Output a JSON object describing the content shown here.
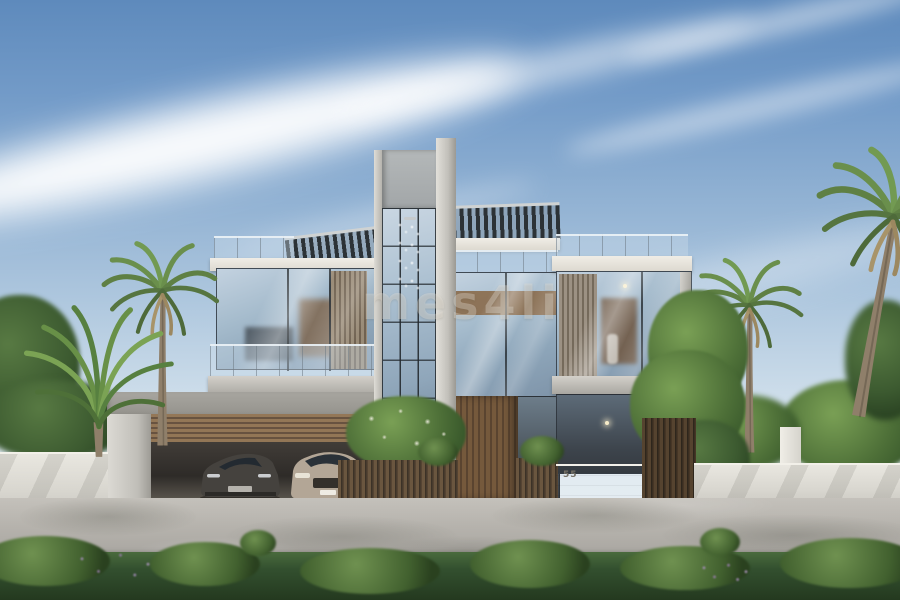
{
  "meta": {
    "type": "architectural-render",
    "description": "Front elevation render of a modern three-storey luxury villa with a central glass tower, glass-box wings, wood louvers, rooftop pergolas, a double carport with two cars, white boundary walls, a gated entrance marked 55, palm trees and garden greenery under a blue sky with wispy clouds"
  },
  "watermark": {
    "text": "mes4li"
  },
  "signage": {
    "house_number": "55"
  },
  "palette": {
    "sky_top": "#5e8abc",
    "sky_horizon": "#edf2f4",
    "cloud": "#ffffff",
    "concrete_light": "#d7d5cf",
    "concrete_mid": "#a9a7a1",
    "fascia_white": "#ece9e2",
    "glass_blue": "#9cb2c8",
    "frame_dark": "#2e3438",
    "wood": "#8a6f52",
    "wood_dark": "#5d4b38",
    "louver_gray_brown": "#8d8071",
    "wall_white": "#e5e3dc",
    "road_gray": "#b6b3ad",
    "hedge_green": "#33502f",
    "palm_green": "#6f9150",
    "flower_purple": "#9a7fae",
    "car_dark": "#45423e",
    "car_light": "#b3a696",
    "interior_warm": "#7e6349",
    "pendant_light": "#f7ecc9"
  },
  "scene": {
    "elements": [
      "sky",
      "cirrus-clouds",
      "glass-tower",
      "chandelier",
      "rooftop-pergolas",
      "glass-railings",
      "wood-louvers",
      "carport",
      "sports-car",
      "suv-car",
      "entry-door",
      "gate-wall",
      "house-number",
      "slat-fences",
      "boundary-walls",
      "palm-trees",
      "garden-trees",
      "driveway-road",
      "foreground-hedge",
      "watermark"
    ]
  }
}
